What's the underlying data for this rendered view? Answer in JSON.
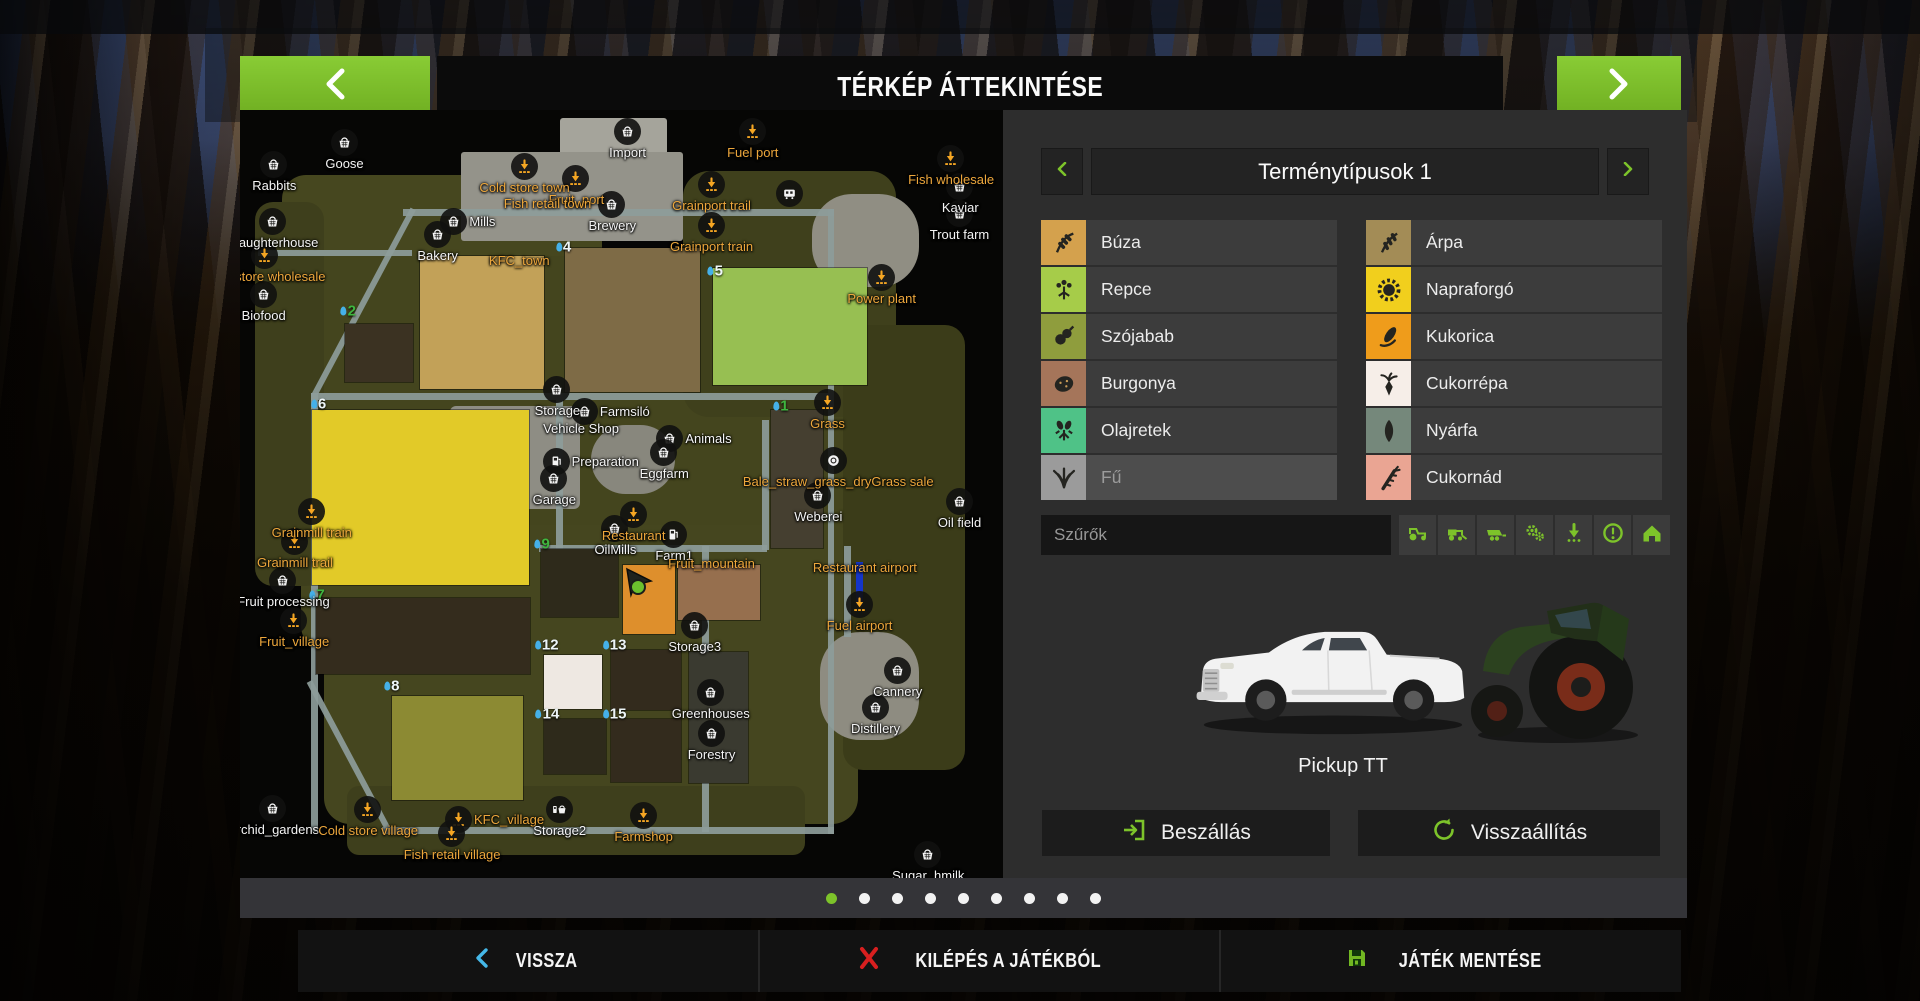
{
  "header": {
    "title": "TÉRKÉP ÁTTEKINTÉSE"
  },
  "colors": {
    "accent_green": "#7dc32a",
    "map_label_orange": "#eda73c",
    "back_arrow_blue": "#45b8e8",
    "quit_x_red": "#d81f1f",
    "save_disk_green": "#72b822",
    "panel_bg": "#2d2d2d",
    "row_bg": "#3c3c3c"
  },
  "panel": {
    "title": "Terménytípusok 1",
    "crops_left": [
      {
        "label": "Búza",
        "color": "#d4a14d",
        "icon": "wheat-icon",
        "disabled": false
      },
      {
        "label": "Repce",
        "color": "#a6cc49",
        "icon": "canola-icon",
        "disabled": false
      },
      {
        "label": "Szójabab",
        "color": "#8f9d3d",
        "icon": "soybean-icon",
        "disabled": false
      },
      {
        "label": "Burgonya",
        "color": "#a5755a",
        "icon": "potato-icon",
        "disabled": false
      },
      {
        "label": "Olajretek",
        "color": "#4fc287",
        "icon": "radish-icon",
        "disabled": false
      },
      {
        "label": "Fű",
        "color": "#9b9b9b",
        "icon": "grass-icon",
        "disabled": true
      }
    ],
    "crops_right": [
      {
        "label": "Árpa",
        "color": "#a38c56",
        "icon": "barley-icon",
        "disabled": false
      },
      {
        "label": "Napraforgó",
        "color": "#f1cf1d",
        "icon": "sunflower-icon",
        "disabled": false
      },
      {
        "label": "Kukorica",
        "color": "#ef9c1b",
        "icon": "corn-icon",
        "disabled": false
      },
      {
        "label": "Cukorrépa",
        "color": "#f6eee8",
        "icon": "sugar-beet-icon",
        "disabled": false
      },
      {
        "label": "Nyárfa",
        "color": "#75887b",
        "icon": "poplar-icon",
        "disabled": false
      },
      {
        "label": "Cukornád",
        "color": "#eaa593",
        "icon": "sugarcane-icon",
        "disabled": false
      }
    ],
    "filter": {
      "placeholder": "Szűrők",
      "buttons": [
        "tractor",
        "harvester",
        "trailer",
        "gears",
        "seeder",
        "warning",
        "house"
      ]
    },
    "vehicle": {
      "name": "Pickup TT"
    },
    "actions": {
      "enter": "Beszállás",
      "reset": "Visszaállítás"
    }
  },
  "pagination": {
    "count": 9,
    "active": 0
  },
  "bottom_bar": [
    {
      "label": "VISSZA",
      "icon": "back-chevron-icon"
    },
    {
      "label": "KILÉPÉS A JÁTÉKBÓL",
      "icon": "close-x-icon"
    },
    {
      "label": "JÁTÉK MENTÉSE",
      "icon": "save-disk-icon"
    }
  ],
  "map": {
    "terrain": [
      {
        "x": 5.5,
        "y": 8.5,
        "w": 42,
        "h": 29,
        "c": "#46471f",
        "r": 24
      },
      {
        "x": 8,
        "y": 19,
        "w": 71,
        "h": 52,
        "c": "#44451e",
        "r": 30
      },
      {
        "x": 11,
        "y": 54,
        "w": 70,
        "h": 39,
        "c": "#45461f",
        "r": 26
      },
      {
        "x": 58,
        "y": 8,
        "w": 28,
        "h": 32,
        "c": "#3f401c",
        "r": 26
      },
      {
        "x": 79,
        "y": 28,
        "w": 16,
        "h": 58,
        "c": "#3b3c19",
        "r": 20
      },
      {
        "x": 2,
        "y": 12,
        "w": 9,
        "h": 50,
        "c": "#3e3f1c",
        "r": 18
      },
      {
        "x": 14,
        "y": 88,
        "w": 60,
        "h": 9,
        "c": "#3e3f1c",
        "r": 12
      },
      {
        "x": 42,
        "y": 1,
        "w": 14,
        "h": 9,
        "c": "#a5a49b",
        "r": 3
      },
      {
        "x": 29,
        "y": 5.5,
        "w": 29,
        "h": 11.5,
        "c": "#94938a",
        "r": 3
      },
      {
        "x": 27.5,
        "y": 38.5,
        "w": 17,
        "h": 13.5,
        "c": "#8e8d84",
        "r": 6
      },
      {
        "x": 75,
        "y": 11,
        "w": 14,
        "h": 12,
        "c": "#908e83",
        "r": 40
      },
      {
        "x": 46,
        "y": 41,
        "w": 11,
        "h": 9,
        "c": "#88877d",
        "r": 40
      },
      {
        "x": 76,
        "y": 68,
        "w": 13,
        "h": 14,
        "c": "#8e8c81",
        "r": 40
      }
    ],
    "fields": [
      {
        "x": 13.7,
        "y": 27.9,
        "w": 9,
        "h": 7.5,
        "c": "#3b3222"
      },
      {
        "x": 23.6,
        "y": 19.0,
        "w": 16.2,
        "h": 17.3,
        "c": "#c2a158"
      },
      {
        "x": 42.6,
        "y": 18.0,
        "w": 17.7,
        "h": 18.7,
        "c": "#7e6b46"
      },
      {
        "x": 62.0,
        "y": 20.6,
        "w": 20.2,
        "h": 15.2,
        "c": "#97bf52"
      },
      {
        "x": 9.5,
        "y": 39.0,
        "w": 28.4,
        "h": 22.8,
        "c": "#e2ca28"
      },
      {
        "x": 9.9,
        "y": 63.6,
        "w": 28.1,
        "h": 9.8,
        "c": "#342c1d"
      },
      {
        "x": 19.9,
        "y": 76.3,
        "w": 17.2,
        "h": 13.6,
        "c": "#8c8a33"
      },
      {
        "x": 39.4,
        "y": 57.2,
        "w": 10.2,
        "h": 8.8,
        "c": "#2e2a1b"
      },
      {
        "x": 50.2,
        "y": 59.2,
        "w": 6.8,
        "h": 9.0,
        "c": "#de8f2c"
      },
      {
        "x": 57.4,
        "y": 59.2,
        "w": 10.8,
        "h": 7.2,
        "c": "#966f4e"
      },
      {
        "x": 39.9,
        "y": 71.0,
        "w": 7.5,
        "h": 7.0,
        "c": "#eee8e2"
      },
      {
        "x": 48.6,
        "y": 70.3,
        "w": 9.2,
        "h": 7.8,
        "c": "#332b1d"
      },
      {
        "x": 39.8,
        "y": 79.3,
        "w": 8.2,
        "h": 7.2,
        "c": "#2e2a1b"
      },
      {
        "x": 48.6,
        "y": 79.3,
        "w": 9.2,
        "h": 8.2,
        "c": "#332b1d"
      },
      {
        "x": 58.8,
        "y": 70.6,
        "w": 7.8,
        "h": 17.0,
        "c": "#3a3a30"
      },
      {
        "x": 69.6,
        "y": 39.0,
        "w": 6.8,
        "h": 18.0,
        "c": "#453f30"
      }
    ],
    "roads": [
      {
        "x": 9.3,
        "y": 36.8,
        "w": 68.3,
        "h": 0.9
      },
      {
        "x": 9.3,
        "y": 36.8,
        "w": 0.9,
        "h": 57.2
      },
      {
        "x": 77.0,
        "y": 12.9,
        "w": 0.9,
        "h": 81.4
      },
      {
        "x": 18.6,
        "y": 93.4,
        "w": 59.3,
        "h": 0.9
      },
      {
        "x": 21.3,
        "y": 12.9,
        "w": 56.6,
        "h": 0.9
      },
      {
        "x": 9.5,
        "y": 36.9,
        "w": 27.5,
        "h": 0.9,
        "rot": -62
      },
      {
        "x": 41.4,
        "y": 37.0,
        "w": 0.9,
        "h": 20.3
      },
      {
        "x": 39.2,
        "y": 56.6,
        "w": 29.9,
        "h": 0.9
      },
      {
        "x": 68.4,
        "y": 40.3,
        "w": 0.9,
        "h": 17.0
      },
      {
        "x": 60.6,
        "y": 56.8,
        "w": 0.9,
        "h": 37.2
      },
      {
        "x": 9.4,
        "y": 74.2,
        "w": 21.8,
        "h": 0.9,
        "rot": 62
      },
      {
        "x": 79.2,
        "y": 56.8,
        "w": 0.9,
        "h": 11.8
      },
      {
        "x": 2.3,
        "y": 18.2,
        "w": 20.3,
        "h": 0.8
      }
    ],
    "runway": {
      "x": 80.7,
      "y": 58.8,
      "w": 0.9,
      "h": 5.6
    },
    "markers": [
      {
        "l": "Rabbits",
        "x": 4.5,
        "y": 7.2,
        "i": "basket",
        "c": "w"
      },
      {
        "l": "Goose",
        "x": 13.7,
        "y": 4.3,
        "i": "basket",
        "c": "w"
      },
      {
        "l": "Import",
        "x": 50.8,
        "y": 2.9,
        "i": "basket",
        "c": "w"
      },
      {
        "l": "Fuel port",
        "x": 67.2,
        "y": 2.9,
        "i": "unload",
        "c": "o"
      },
      {
        "l": "Fish wholesale",
        "x": 93.2,
        "y": 6.4,
        "i": "unload",
        "c": "o"
      },
      {
        "l": "Kaviar",
        "x": 94.4,
        "y": 10.0,
        "i": "basket",
        "c": "w"
      },
      {
        "l": "Trout farm",
        "x": 94.3,
        "y": 13.6,
        "i": "basket",
        "c": "w"
      },
      {
        "l": "Slaughterhouse",
        "x": 4.3,
        "y": 14.6,
        "i": "basket",
        "c": "w"
      },
      {
        "l": "Cold store wholesale",
        "x": 3.3,
        "y": 19.0,
        "i": "unload",
        "c": "o"
      },
      {
        "l": "Biofood",
        "x": 3.1,
        "y": 24.1,
        "i": "basket",
        "c": "w"
      },
      {
        "l": "Cold store town",
        "x": 37.3,
        "y": 7.4,
        "i": "unload",
        "c": "o"
      },
      {
        "l": "Fruit_port",
        "x": 44.1,
        "y": 9.0,
        "i": "unload",
        "c": "o"
      },
      {
        "l": "Fish retail town",
        "x": 40.3,
        "y": 12.2,
        "i": "none",
        "c": "o"
      },
      {
        "l": "Mills",
        "x": 28.1,
        "y": 14.6,
        "i": "basket",
        "c": "w",
        "lp": "r"
      },
      {
        "l": "Bakery",
        "x": 25.9,
        "y": 16.3,
        "i": "basket",
        "c": "w"
      },
      {
        "l": "Brewery",
        "x": 48.8,
        "y": 12.4,
        "i": "basket",
        "c": "w"
      },
      {
        "l": "Grainport trail",
        "x": 61.8,
        "y": 9.8,
        "i": "unload",
        "c": "o"
      },
      {
        "l": "Grainport train",
        "x": 61.8,
        "y": 15.1,
        "i": "unload",
        "c": "o"
      },
      {
        "l": "KFC_town",
        "x": 36.6,
        "y": 19.7,
        "i": "none",
        "c": "o"
      },
      {
        "l": "Power plant",
        "x": 84.1,
        "y": 21.9,
        "i": "unload",
        "c": "o"
      },
      {
        "l": "",
        "x": 72.1,
        "y": 10.9,
        "i": "train",
        "c": "w",
        "n": "train-wagon-icon"
      },
      {
        "l": "Storage",
        "x": 41.6,
        "y": 36.4,
        "i": "basket",
        "c": "w"
      },
      {
        "l": "Farmsiló",
        "x": 45.2,
        "y": 39.3,
        "i": "basket",
        "c": "w",
        "lp": "r"
      },
      {
        "l": "Vehicle Shop",
        "x": 44.7,
        "y": 41.6,
        "i": "none",
        "c": "w"
      },
      {
        "l": "Animals",
        "x": 56.4,
        "y": 42.9,
        "i": "basket",
        "c": "w",
        "lp": "r"
      },
      {
        "l": "Eggfarm",
        "x": 55.6,
        "y": 44.7,
        "i": "basket",
        "c": "w"
      },
      {
        "l": "Preparation",
        "x": 41.5,
        "y": 45.8,
        "i": "fuel",
        "c": "w",
        "lp": "r"
      },
      {
        "l": "Garage",
        "x": 41.2,
        "y": 48.0,
        "i": "basket",
        "c": "w"
      },
      {
        "l": "Grass",
        "x": 77.0,
        "y": 38.2,
        "i": "unload",
        "c": "o"
      },
      {
        "l": "",
        "x": 77.9,
        "y": 45.7,
        "i": "bale",
        "c": "w",
        "n": "bale-sale-icon"
      },
      {
        "l": "Bale_straw_grass_dryGrass sale",
        "x": 78.4,
        "y": 48.4,
        "i": "none",
        "c": "o"
      },
      {
        "l": "Weberei",
        "x": 75.8,
        "y": 50.2,
        "i": "basket",
        "c": "w"
      },
      {
        "l": "Oil field",
        "x": 94.3,
        "y": 51.0,
        "i": "basket",
        "c": "w"
      },
      {
        "l": "Grainmill train",
        "x": 9.4,
        "y": 52.4,
        "i": "unload",
        "c": "o"
      },
      {
        "l": "Grainmill trail",
        "x": 7.2,
        "y": 56.3,
        "i": "unload",
        "c": "o"
      },
      {
        "l": "Fruit processing",
        "x": 5.7,
        "y": 61.3,
        "i": "basket",
        "c": "w"
      },
      {
        "l": "Fruit_village",
        "x": 7.1,
        "y": 66.6,
        "i": "unload",
        "c": "o"
      },
      {
        "l": "Restaurant",
        "x": 51.6,
        "y": 52.7,
        "i": "unload",
        "c": "o"
      },
      {
        "l": "OilMills",
        "x": 49.2,
        "y": 54.6,
        "i": "basket",
        "c": "w"
      },
      {
        "l": "Farm1",
        "x": 56.9,
        "y": 55.3,
        "i": "fuel",
        "c": "w"
      },
      {
        "l": "Fruit_mountain",
        "x": 61.8,
        "y": 59.1,
        "i": "none",
        "c": "o"
      },
      {
        "l": "Storage3",
        "x": 59.6,
        "y": 67.2,
        "i": "basket",
        "c": "w"
      },
      {
        "l": "Restaurant airport",
        "x": 81.9,
        "y": 59.7,
        "i": "none",
        "c": "o"
      },
      {
        "l": "Fuel airport",
        "x": 81.2,
        "y": 64.5,
        "i": "unload",
        "c": "o"
      },
      {
        "l": "Greenhouses",
        "x": 61.7,
        "y": 75.9,
        "i": "basket",
        "c": "w"
      },
      {
        "l": "Forestry",
        "x": 61.8,
        "y": 81.3,
        "i": "basket",
        "c": "w"
      },
      {
        "l": "Cannery",
        "x": 86.2,
        "y": 73.1,
        "i": "basket",
        "c": "w"
      },
      {
        "l": "Distillery",
        "x": 83.3,
        "y": 77.8,
        "i": "basket",
        "c": "w"
      },
      {
        "l": "Orchid_gardens",
        "x": 4.3,
        "y": 91.0,
        "i": "basket",
        "c": "w"
      },
      {
        "l": "Cold store village",
        "x": 16.8,
        "y": 91.2,
        "i": "unload",
        "c": "o"
      },
      {
        "l": "KFC_village",
        "x": 28.7,
        "y": 92.4,
        "i": "unload",
        "c": "o",
        "lp": "r"
      },
      {
        "l": "Fish retail village",
        "x": 27.8,
        "y": 94.3,
        "i": "unload",
        "c": "o"
      },
      {
        "l": "Storage2",
        "x": 41.9,
        "y": 91.2,
        "i": "fuel-basket",
        "c": "w"
      },
      {
        "l": "Farmshop",
        "x": 52.9,
        "y": 91.9,
        "i": "unload",
        "c": "o"
      },
      {
        "l": "Sugar_hmilk",
        "x": 90.2,
        "y": 97.0,
        "i": "basket",
        "c": "w"
      }
    ],
    "field_numbers": [
      {
        "n": "4",
        "x": 42.4,
        "y": 17.8,
        "g": false
      },
      {
        "n": "5",
        "x": 62.3,
        "y": 20.9,
        "g": false
      },
      {
        "n": "2",
        "x": 14.2,
        "y": 26.2,
        "g": true
      },
      {
        "n": "6",
        "x": 10.3,
        "y": 38.3,
        "g": false
      },
      {
        "n": "1",
        "x": 70.9,
        "y": 38.5,
        "g": true
      },
      {
        "n": "9",
        "x": 39.6,
        "y": 56.5,
        "g": true
      },
      {
        "n": "7",
        "x": 10.1,
        "y": 63.2,
        "g": true
      },
      {
        "n": "8",
        "x": 19.9,
        "y": 75.0,
        "g": false
      },
      {
        "n": "12",
        "x": 40.2,
        "y": 69.6,
        "g": false
      },
      {
        "n": "13",
        "x": 49.1,
        "y": 69.6,
        "g": false
      },
      {
        "n": "14",
        "x": 40.3,
        "y": 78.7,
        "g": false
      },
      {
        "n": "15",
        "x": 49.1,
        "y": 78.7,
        "g": false
      }
    ],
    "player": {
      "x": 52.1,
      "y": 61.5
    }
  }
}
